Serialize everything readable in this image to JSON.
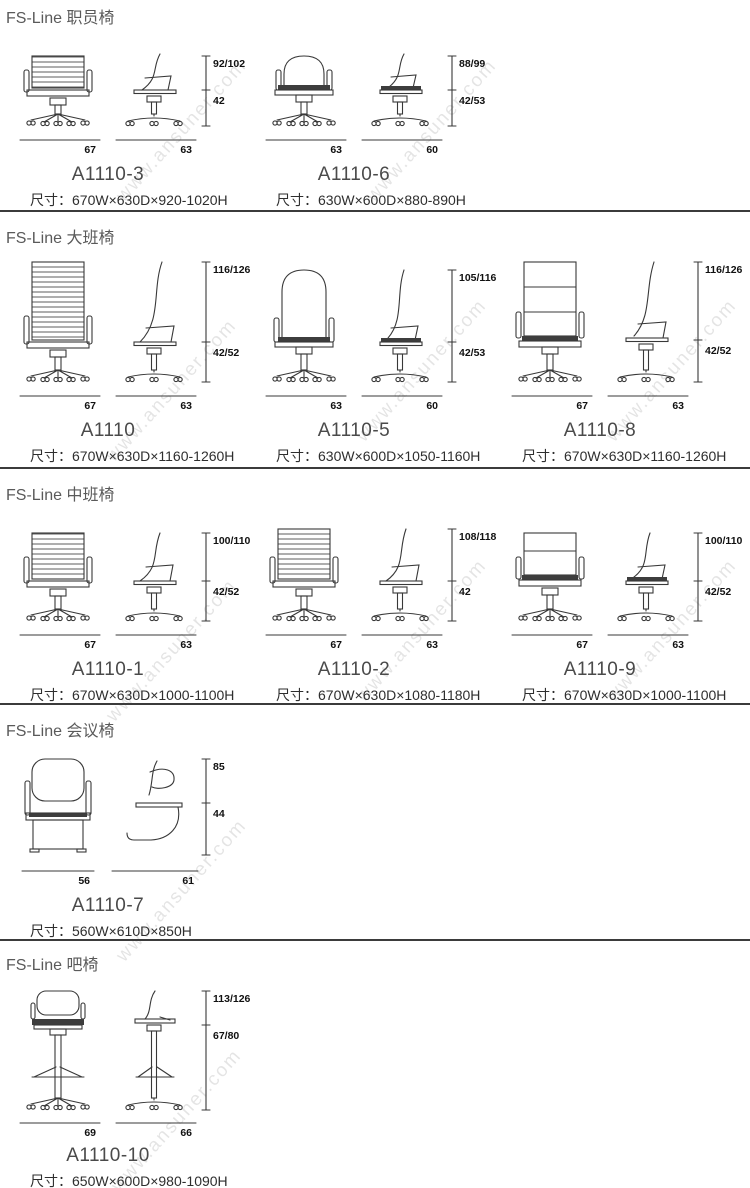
{
  "watermark": "www.ansuner.com",
  "sections": [
    {
      "title": "FS-Line 职员椅",
      "chairs": [
        {
          "model": "A1110-3",
          "size": "尺寸：670W×630D×920-1020H",
          "height": "92/102",
          "seat_height": "42",
          "front_width": "67",
          "side_width": "63"
        },
        {
          "model": "A1110-6",
          "size": "尺寸：630W×600D×880-890H",
          "height": "88/99",
          "seat_height": "42/53",
          "front_width": "63",
          "side_width": "60"
        }
      ]
    },
    {
      "title": "FS-Line 大班椅",
      "chairs": [
        {
          "model": "A1110",
          "size": "尺寸：670W×630D×1160-1260H",
          "height": "116/126",
          "seat_height": "42/52",
          "front_width": "67",
          "side_width": "63"
        },
        {
          "model": "A1110-5",
          "size": "尺寸：630W×600D×1050-1160H",
          "height": "105/116",
          "seat_height": "42/53",
          "front_width": "63",
          "side_width": "60"
        },
        {
          "model": "A1110-8",
          "size": "尺寸：670W×630D×1160-1260H",
          "height": "116/126",
          "seat_height": "42/52",
          "front_width": "67",
          "side_width": "63"
        }
      ]
    },
    {
      "title": "FS-Line 中班椅",
      "chairs": [
        {
          "model": "A1110-1",
          "size": "尺寸：670W×630D×1000-1100H",
          "height": "100/110",
          "seat_height": "42/52",
          "front_width": "67",
          "side_width": "63"
        },
        {
          "model": "A1110-2",
          "size": "尺寸：670W×630D×1080-1180H",
          "height": "108/118",
          "seat_height": "42",
          "front_width": "67",
          "side_width": "63"
        },
        {
          "model": "A1110-9",
          "size": "尺寸：670W×630D×1000-1100H",
          "height": "100/110",
          "seat_height": "42/52",
          "front_width": "67",
          "side_width": "63"
        }
      ]
    },
    {
      "title": "FS-Line 会议椅",
      "chairs": [
        {
          "model": "A1110-7",
          "size": "尺寸：560W×610D×850H",
          "height": "85",
          "seat_height": "44",
          "front_width": "56",
          "side_width": "61"
        }
      ]
    },
    {
      "title": "FS-Line 吧椅",
      "chairs": [
        {
          "model": "A1110-10",
          "size": "尺寸：650W×600D×980-1090H",
          "height": "113/126",
          "seat_height": "67/80",
          "front_width": "69",
          "side_width": "66"
        }
      ]
    }
  ]
}
